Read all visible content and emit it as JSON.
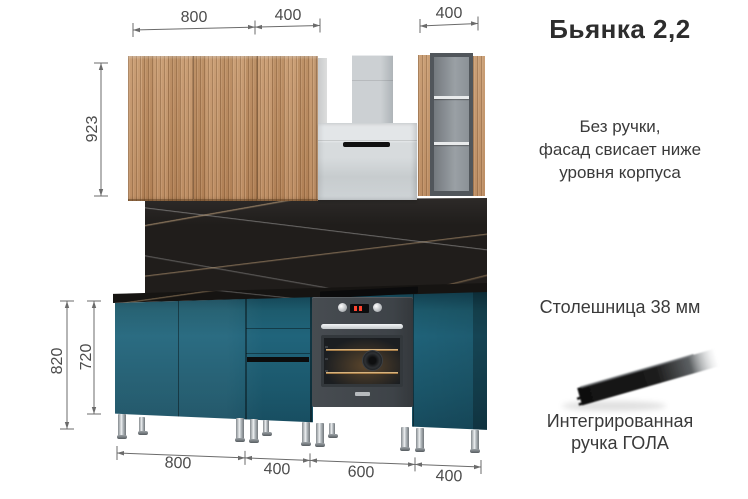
{
  "title": "Бьянка 2,2",
  "notes": {
    "no_handle_line1": "Без ручки,",
    "no_handle_line2": "фасад свисает ниже",
    "no_handle_line3": "уровня корпуса",
    "countertop": "Столешница 38 мм",
    "gola_line1": "Интегрированная",
    "gola_line2": "ручка ГОЛА"
  },
  "dimensions": {
    "top_wall_left": "800",
    "top_wall_mid": "400",
    "top_wall_right": "400",
    "wall_cabinet_height": "923",
    "base_total_height": "820",
    "base_cabinet_height": "720",
    "bottom_base_1": "800",
    "bottom_base_2": "400",
    "bottom_base_3": "600",
    "bottom_base_4": "400"
  },
  "colors": {
    "facade_teal": "#1d5b6d",
    "facade_wood": "#c0906a",
    "marble_black": "#1e1c1a",
    "hood_grey": "#cdd2d5",
    "text_dark": "#2d2d2d",
    "dimension_grey": "#6b6b6b"
  }
}
